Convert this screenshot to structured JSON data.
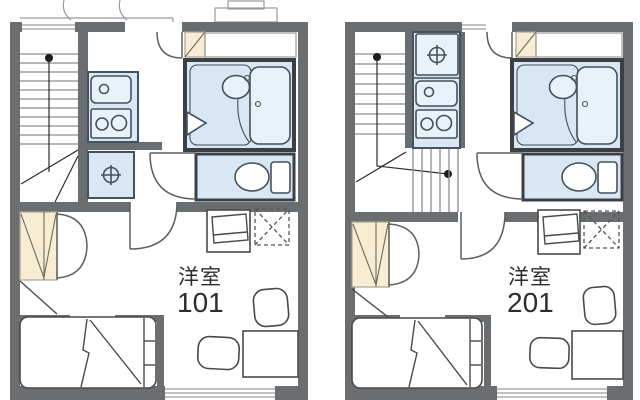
{
  "page": {
    "type": "apartment-floor-plan",
    "background": "#ffffff"
  },
  "colors": {
    "wall": "#6b6e71",
    "fixture_fill": "#d8e7f3",
    "fixture_fill_light": "#e9f1f9",
    "fixture_stroke": "#44515e",
    "bath_border": "#3c4046",
    "closet_fill": "#f6edd2",
    "line": "#4a4a4a",
    "stair_line": "#8c8c8c",
    "thin": "#9a9a9a",
    "text": "#2d2d2d",
    "bg": "#ffffff"
  },
  "units": [
    {
      "room_type_label": "洋室",
      "room_number": "101",
      "fixtures": [
        "staircase",
        "kitchen-sink",
        "gas-stove",
        "washing-machine-space",
        "entrance-door",
        "shoe-cabinet",
        "storage-counter",
        "unit-bathroom",
        "bathtub",
        "wash-basin",
        "toilet",
        "closet",
        "bed",
        "tv-stand",
        "air-conditioner-space",
        "chair",
        "chair",
        "desk",
        "window"
      ]
    },
    {
      "room_type_label": "洋室",
      "room_number": "201",
      "fixtures": [
        "staircase",
        "kitchen-sink",
        "gas-stove",
        "washing-machine-space",
        "entrance-door",
        "shoe-cabinet",
        "storage-counter",
        "unit-bathroom",
        "bathtub",
        "wash-basin",
        "toilet",
        "closet",
        "bed",
        "tv-stand",
        "air-conditioner-space",
        "chair",
        "chair",
        "desk",
        "window"
      ]
    }
  ],
  "icons": {
    "washing-machine-icon": "⊕ circle-with-cross tap symbol",
    "stair-direction-dot": "● filled dot with run line",
    "ac-space-icon": "dashed square with X",
    "door-swing-icon": "quarter-circle arc with leaf line",
    "folding-door-icon": "triangle",
    "closet-icon": "beige box with diagonal lines",
    "stove-icon": "two burner circles",
    "sink-icon": "rounded box with drain circle",
    "toilet-icon": "bowl ellipse with tank"
  }
}
